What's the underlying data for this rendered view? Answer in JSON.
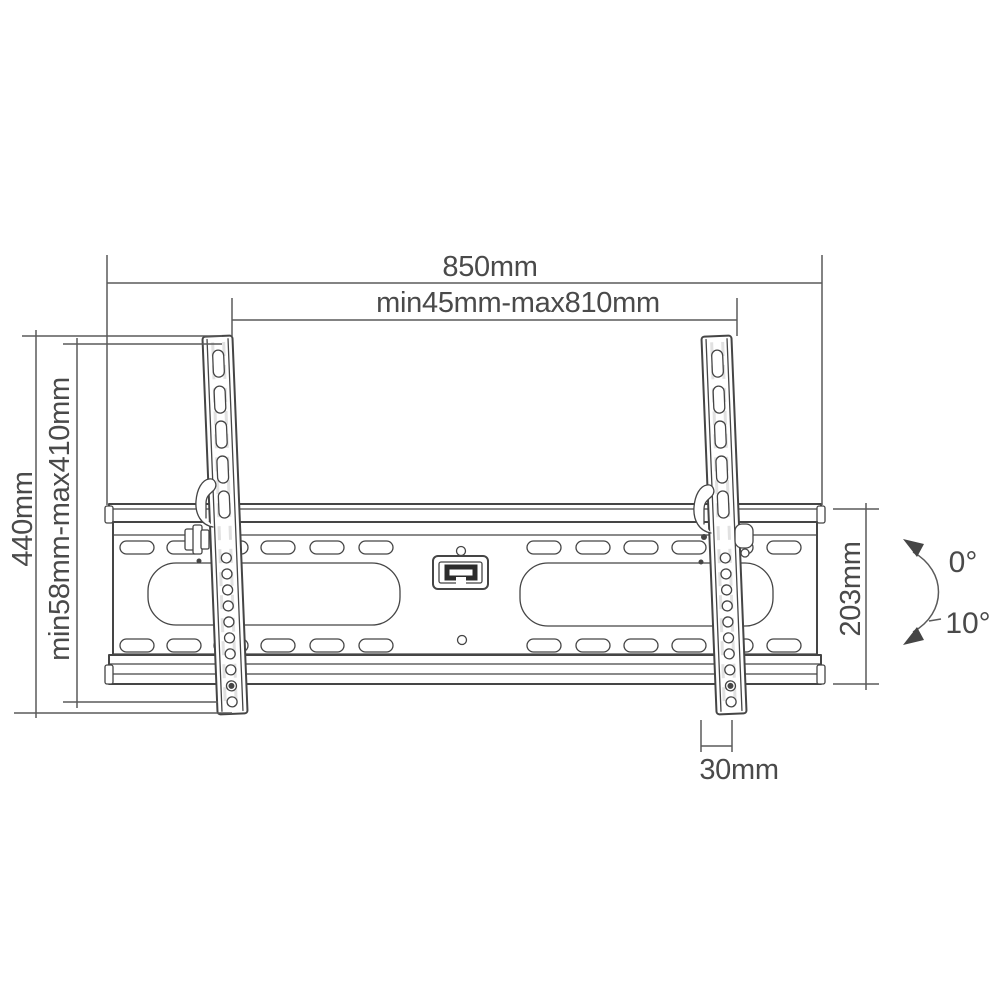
{
  "title": "Tilting TV wall mount bracket dimensional drawing",
  "colors": {
    "paper": "#ffffff",
    "line": "#454545",
    "dim": "#5a5a5a",
    "text": "#4a4a4a"
  },
  "dimensions": {
    "overall_width": "850mm",
    "horizontal_adjust_range": "min45mm-max810mm",
    "overall_height": "440mm",
    "vertical_adjust_range": "min58mm-max410mm",
    "wall_plate_height": "203mm",
    "bracket_arm_width": "30mm"
  },
  "tilt": {
    "up": "0°",
    "down": "10°"
  }
}
